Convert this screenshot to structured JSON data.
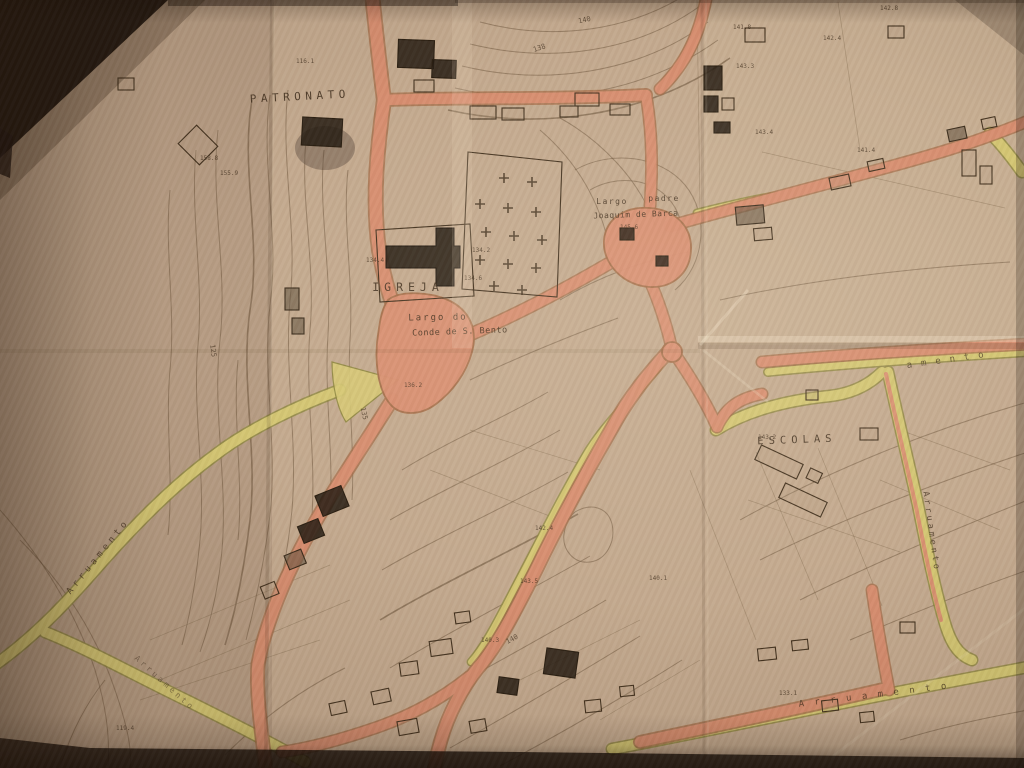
{
  "meta": {
    "type": "photograph of a folded hand-coloured topographic town plan",
    "language": "pt"
  },
  "colors": {
    "paper": "#c4aa8f",
    "paper_shadow": "#8a7158",
    "road_orange": "#d98f71",
    "road_orange_edge": "#a7714d",
    "road_yellow": "#d7c975",
    "road_yellow_edge": "#8f8840",
    "ink": "#3e2d1c",
    "contour": "#6e573d",
    "dark_building": "#241b12"
  },
  "labels": [
    {
      "id": "patronato",
      "text": "PATRONATO",
      "x": 300,
      "y": 100,
      "rot": -3,
      "size": 11,
      "spacing": 4.5
    },
    {
      "id": "igreja",
      "text": "IGREJA",
      "x": 408,
      "y": 291,
      "rot": 0,
      "size": 11.5,
      "spacing": 5
    },
    {
      "id": "largo-conde-line1",
      "text": "Largo do",
      "x": 438,
      "y": 320,
      "rot": -1,
      "size": 9,
      "spacing": 2
    },
    {
      "id": "largo-conde-line2",
      "text": "Conde de S. Bento",
      "x": 460,
      "y": 334,
      "rot": -2,
      "size": 8.5,
      "spacing": 0.5
    },
    {
      "id": "largo-padre-word1",
      "text": "Largo",
      "x": 612,
      "y": 204,
      "rot": 0,
      "size": 8,
      "spacing": 1.5
    },
    {
      "id": "largo-padre-word2",
      "text": "padre",
      "x": 664,
      "y": 201,
      "rot": 0,
      "size": 8,
      "spacing": 1.5
    },
    {
      "id": "largo-padre-line2",
      "text": "Joaquim de Barca",
      "x": 636,
      "y": 217,
      "rot": -2,
      "size": 8,
      "spacing": 0.5
    },
    {
      "id": "escolas",
      "text": "ESCOLAS",
      "x": 797,
      "y": 443,
      "rot": -2,
      "size": 10.5,
      "spacing": 5
    },
    {
      "id": "arruamento-left",
      "text": "Arruamento",
      "x": 100,
      "y": 558,
      "rot": -51,
      "size": 9,
      "spacing": 4,
      "opacity": 0.75
    },
    {
      "id": "arruamento-top-right",
      "text": "amento",
      "x": 950,
      "y": 362,
      "rot": -8,
      "size": 9,
      "spacing": 9,
      "opacity": 0.75
    },
    {
      "id": "arruamento-right-vertical",
      "text": "Arruamento",
      "x": 929,
      "y": 532,
      "rot": 82,
      "size": 8.5,
      "spacing": 3,
      "opacity": 0.75
    },
    {
      "id": "arruamento-bottom",
      "text": "Arruamento",
      "x": 878,
      "y": 697,
      "rot": -7,
      "size": 9,
      "spacing": 10.5,
      "opacity": 0.75
    },
    {
      "id": "arruamento-bottom-left",
      "text": "Arruamento",
      "x": 163,
      "y": 685,
      "rot": 42,
      "size": 8,
      "spacing": 3,
      "opacity": 0.5
    }
  ],
  "contour_labels": [
    {
      "id": "contour-140-top",
      "text": "140",
      "x": 585,
      "y": 22,
      "rot": -12,
      "size": 7
    },
    {
      "id": "contour-138-top",
      "text": "138",
      "x": 540,
      "y": 50,
      "rot": -18,
      "size": 7
    },
    {
      "id": "contour-135-center",
      "text": "135",
      "x": 362,
      "y": 414,
      "rot": 78,
      "size": 7
    },
    {
      "id": "contour-140-bottom",
      "text": "140",
      "x": 513,
      "y": 641,
      "rot": -28,
      "size": 7
    },
    {
      "id": "contour-125-left",
      "text": "125",
      "x": 211,
      "y": 351,
      "rot": 82,
      "size": 7
    }
  ],
  "spot_heights": [
    {
      "text": "141.8",
      "x": 733,
      "y": 29
    },
    {
      "text": "142.8",
      "x": 880,
      "y": 10
    },
    {
      "text": "142.4",
      "x": 823,
      "y": 40
    },
    {
      "text": "143.3",
      "x": 736,
      "y": 68
    },
    {
      "text": "143.4",
      "x": 755,
      "y": 134
    },
    {
      "text": "141.4",
      "x": 857,
      "y": 152
    },
    {
      "text": "116.1",
      "x": 296,
      "y": 63
    },
    {
      "text": "158.8",
      "x": 200,
      "y": 160
    },
    {
      "text": "155.9",
      "x": 220,
      "y": 175
    },
    {
      "text": "134.4",
      "x": 366,
      "y": 262
    },
    {
      "text": "134.2",
      "x": 472,
      "y": 252
    },
    {
      "text": "134.6",
      "x": 464,
      "y": 280
    },
    {
      "text": "145.6",
      "x": 620,
      "y": 229
    },
    {
      "text": "136.2",
      "x": 404,
      "y": 387
    },
    {
      "text": "143.2",
      "x": 758,
      "y": 439
    },
    {
      "text": "142.4",
      "x": 535,
      "y": 530
    },
    {
      "text": "143.5",
      "x": 520,
      "y": 583
    },
    {
      "text": "140.1",
      "x": 649,
      "y": 580
    },
    {
      "text": "140.3",
      "x": 481,
      "y": 642
    },
    {
      "text": "133.1",
      "x": 779,
      "y": 695
    },
    {
      "text": "119.4",
      "x": 116,
      "y": 730
    }
  ]
}
